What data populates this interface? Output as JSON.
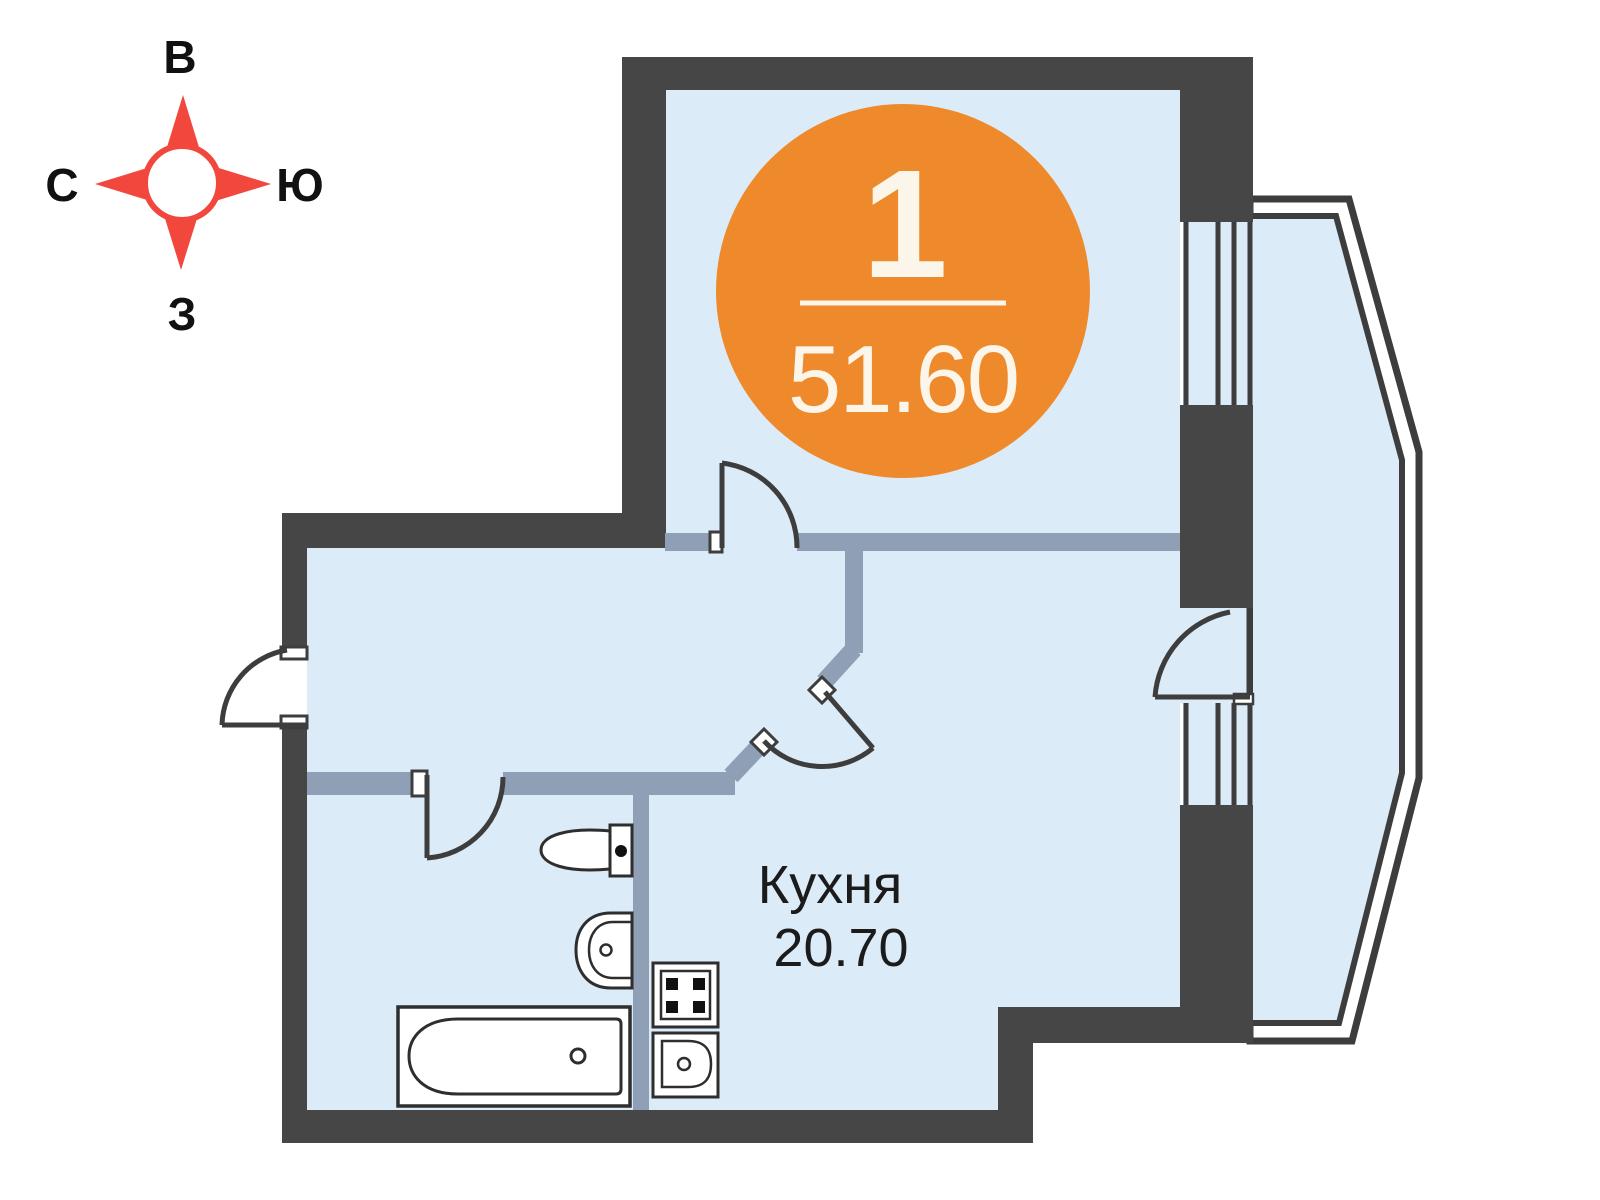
{
  "palette": {
    "wall": "#464646",
    "partition": "#8E9FB6",
    "floor": "#DCEBF8",
    "outline": "#3D3D3D",
    "accent_orange": "#EF8A2C",
    "badge_text": "#FBF6E9",
    "compass_red": "#F2473D",
    "label_text": "#1B1B1B"
  },
  "compass": {
    "top": "В",
    "left": "С",
    "right": "Ю",
    "bottom": "З"
  },
  "badge": {
    "rooms": "1",
    "total_area": "51.60"
  },
  "rooms": [
    {
      "name": "Кухня",
      "area": "20.70"
    }
  ],
  "fixtures": [
    "bathtub-icon",
    "toilet-icon",
    "washbasin-icon",
    "stove-icon",
    "kitchen-sink-icon"
  ]
}
